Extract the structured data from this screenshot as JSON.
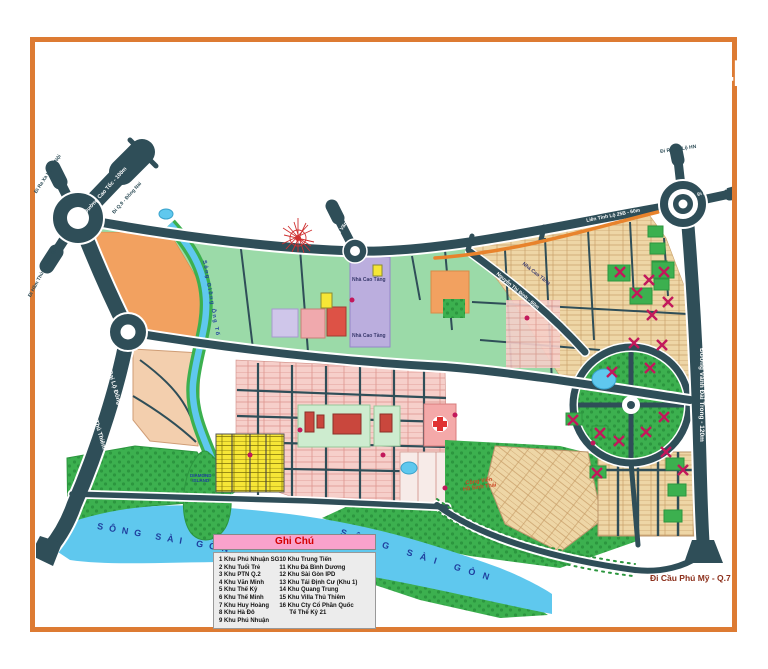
{
  "palette": {
    "frame_orange": "#dd7b33",
    "banner_orange": "#e4813c",
    "road_dark": "#2f4e58",
    "water_blue": "#5fc8ee",
    "park_green": "#3cb04f",
    "zone_green_light": "#9bdaa8",
    "zone_orange": "#f2a160",
    "zone_purple": "#bbaede",
    "zone_pink": "#f6cfca",
    "zone_tan": "#eed6a6",
    "zone_yellow": "#f6e636",
    "x_mark_red": "#c2185b",
    "legend_pink": "#f9a2cc",
    "label_navy": "#1f3f9e"
  },
  "header": {
    "subtitle_line1": "BẢN ĐỒ",
    "subtitle_line2": "QUY HOẠCH",
    "title": "TỔNG THỂ THẠNH MỸ LỢI 174HA"
  },
  "roads": {
    "di_ra_xa_lo_ha_noi": "Đi Ra Xa Lộ Hà Nội",
    "duong_cao_toc": "Đường Cao Tốc - 100m",
    "di_q9_dong_nai": "Đi Q.9 - Đồng Nai",
    "di_ham_thu_thiem_q1": "Đi Hầm Thủ Thiêm - Q.1",
    "dai_lo_dong_tay": "Đại Lộ Đông Tây - 120m",
    "di_ham_thu_thiem": "Đi Hầm Thủ Thiêm",
    "di_le_van_thinh": "Đi Lê Văn Thịnh",
    "lien_tinh_lo_25b": "Liên Tỉnh Lộ 25B - 60m",
    "di_ra_xa_lo_hn": "Đi Ra Xa Lộ HN",
    "di_pha_cat_lai": "Đi Phà Cát Lái",
    "vanh_dai_trong": "Đường Vành Đai Trong - 120m",
    "nguyen_thi_dinh": "Nguyễn Thị Định - 60m",
    "di_cau_phu_my": "Đi Cầu Phú Mỹ - Q.7"
  },
  "places": {
    "song_sai_gon": "SÔNG  SÀI  GÒN",
    "song_giong_ong_to": "Sông Giồng Ông Tố",
    "diamond_line1": "DIAMOND",
    "diamond_line2": "ISLAND",
    "nha_cao_tang": "Nhà Cao Tầng",
    "cong_vien_line1": "Công Viên",
    "cong_vien_line2": "Hồ Sinh Thái"
  },
  "legend": {
    "title": "Ghi Chú",
    "column1": [
      "1 Khu Phú Nhuận SG",
      "2 Khu Tuổi Trẻ",
      "3 Khu PTN Q.2",
      "4 Khu Văn Minh",
      "5 Khu Thế Kỷ",
      "6 Khu Thế Minh",
      "7 Khu Huy Hoàng",
      "8 Khu Hà Đô",
      "9 Khu Phú Nhuận"
    ],
    "column2": [
      "10 Khu Trung Tiến",
      "11 Khu Đá Bình Dương",
      "12 Khu Sài Gòn IPD",
      "13 Khu Tái Định Cư (Khu 1)",
      "14 Khu Quang Trung",
      "15 Khu Villa Thủ Thiêm",
      "16 Khu Cty Cổ Phần Quốc"
    ],
    "column2_wrap": "Tế Thế Kỷ 21"
  }
}
